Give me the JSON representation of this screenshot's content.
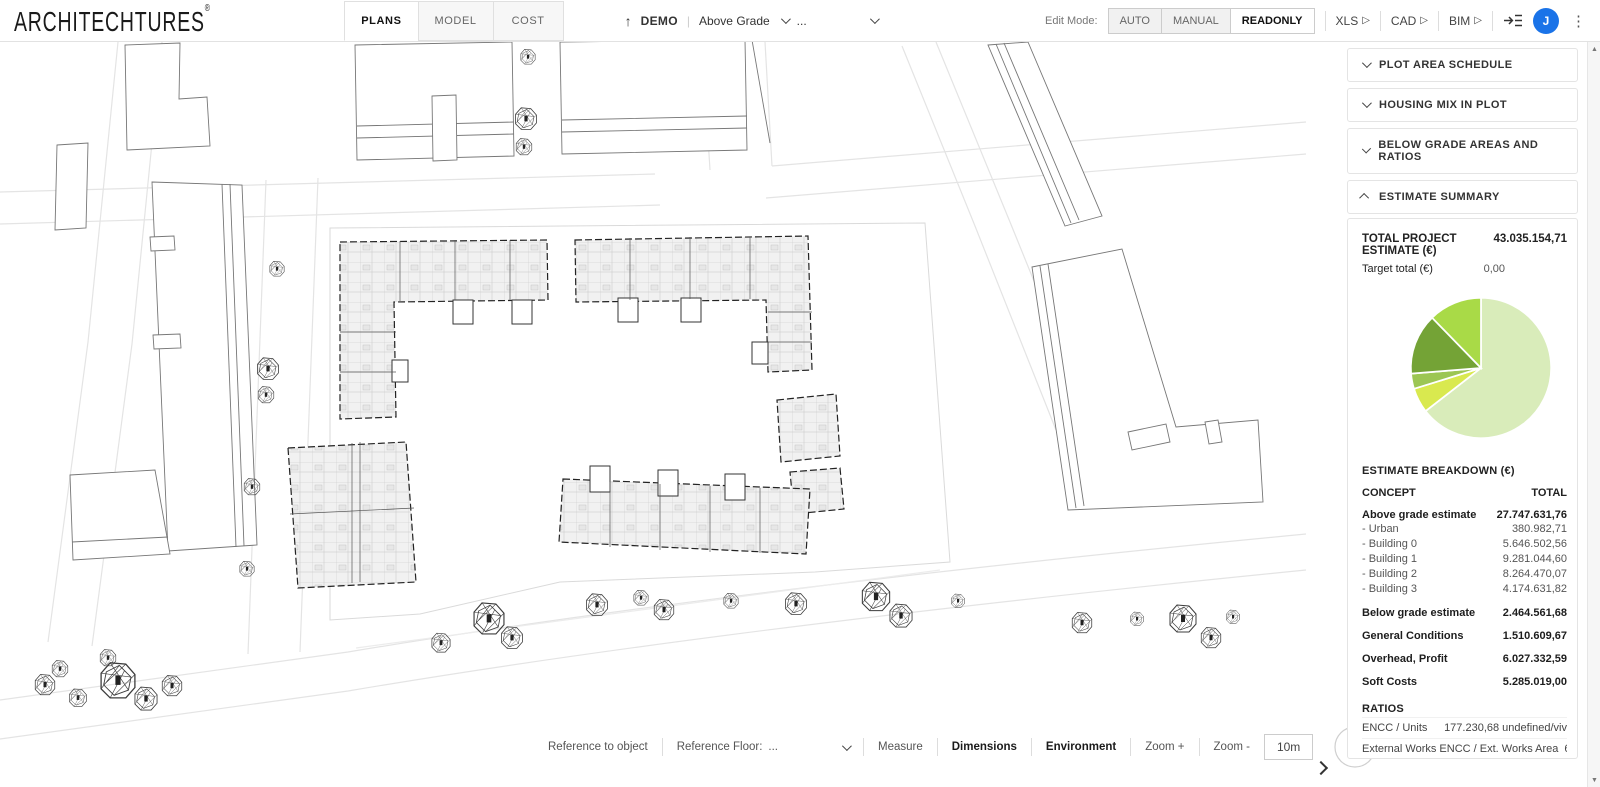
{
  "header": {
    "logo": "ARCHITECHTURES",
    "logo_reg": "®",
    "tabs": [
      {
        "label": "PLANS",
        "active": true
      },
      {
        "label": "MODEL",
        "active": false
      },
      {
        "label": "COST",
        "active": false
      }
    ],
    "project": {
      "name": "DEMO",
      "level_selector": "Above Grade",
      "ellipsis": "..."
    },
    "edit_mode": {
      "label": "Edit Mode:",
      "options": [
        "AUTO",
        "MANUAL",
        "READONLY"
      ],
      "selected": "READONLY"
    },
    "exports": {
      "xls": "XLS",
      "cad": "CAD",
      "bim": "BIM"
    },
    "avatar_initial": "J"
  },
  "sidebar": {
    "panels": [
      {
        "title": "PLOT AREA SCHEDULE",
        "collapsed": true
      },
      {
        "title": "HOUSING MIX IN PLOT",
        "collapsed": true
      },
      {
        "title": "BELOW GRADE AREAS AND RATIOS",
        "collapsed": true
      },
      {
        "title": "ESTIMATE SUMMARY",
        "collapsed": false
      }
    ],
    "estimate": {
      "total_label": "TOTAL PROJECT ESTIMATE (€)",
      "total_value": "43.035.154,71",
      "target_label": "Target total (€)",
      "target_value": "0,00",
      "breakdown_title": "ESTIMATE BREAKDOWN (€)",
      "col_concept": "CONCEPT",
      "col_total": "TOTAL",
      "rows": [
        {
          "label": "Above grade estimate",
          "value": "27.747.631,76"
        },
        {
          "label": "- Urban",
          "value": "380.982,71"
        },
        {
          "label": "- Building 0",
          "value": "5.646.502,56"
        },
        {
          "label": "- Building 1",
          "value": "9.281.044,60"
        },
        {
          "label": "- Building 2",
          "value": "8.264.470,07"
        },
        {
          "label": "- Building 3",
          "value": "4.174.631,82"
        },
        {
          "label": "Below grade estimate",
          "value": "2.464.561,68"
        },
        {
          "label": "General Conditions",
          "value": "1.510.609,67"
        },
        {
          "label": "Overhead, Profit",
          "value": "6.027.332,59"
        },
        {
          "label": "Soft Costs",
          "value": "5.285.019,00"
        }
      ],
      "ratios_title": "RATIOS",
      "ratios": [
        {
          "label": "ENCC / Units",
          "value": "177.230,68 undefined/viv"
        },
        {
          "label": "External Works ENCC / Ext. Works Area",
          "value": "65,82 undefined"
        },
        {
          "label": "PEC Res / Sup Res",
          "value": "670,86 undefined"
        },
        {
          "label": "B.G. ENCC / B.G. Area",
          "value": "332,10 undefined"
        }
      ]
    }
  },
  "chart_data": {
    "type": "pie",
    "title": "Total project estimate distribution (€)",
    "labels": [
      "Above grade estimate",
      "Below grade estimate",
      "General Conditions",
      "Overhead, Profit",
      "Soft Costs"
    ],
    "values": [
      27747631.76,
      2464561.68,
      1510609.67,
      6027332.59,
      5285019.0
    ],
    "colors": [
      "#d9ecba",
      "#d9e94f",
      "#9cc653",
      "#74a336",
      "#a9da47"
    ],
    "start_angle_deg": 0,
    "direction": "clockwise",
    "legend": false
  },
  "toolbar": {
    "reference_to_object": "Reference to object",
    "reference_floor_label": "Reference Floor:",
    "reference_floor_value": "...",
    "measure": "Measure",
    "dimensions": "Dimensions",
    "environment": "Environment",
    "zoom_in": "Zoom +",
    "zoom_out": "Zoom -",
    "scale_label": "10m"
  }
}
